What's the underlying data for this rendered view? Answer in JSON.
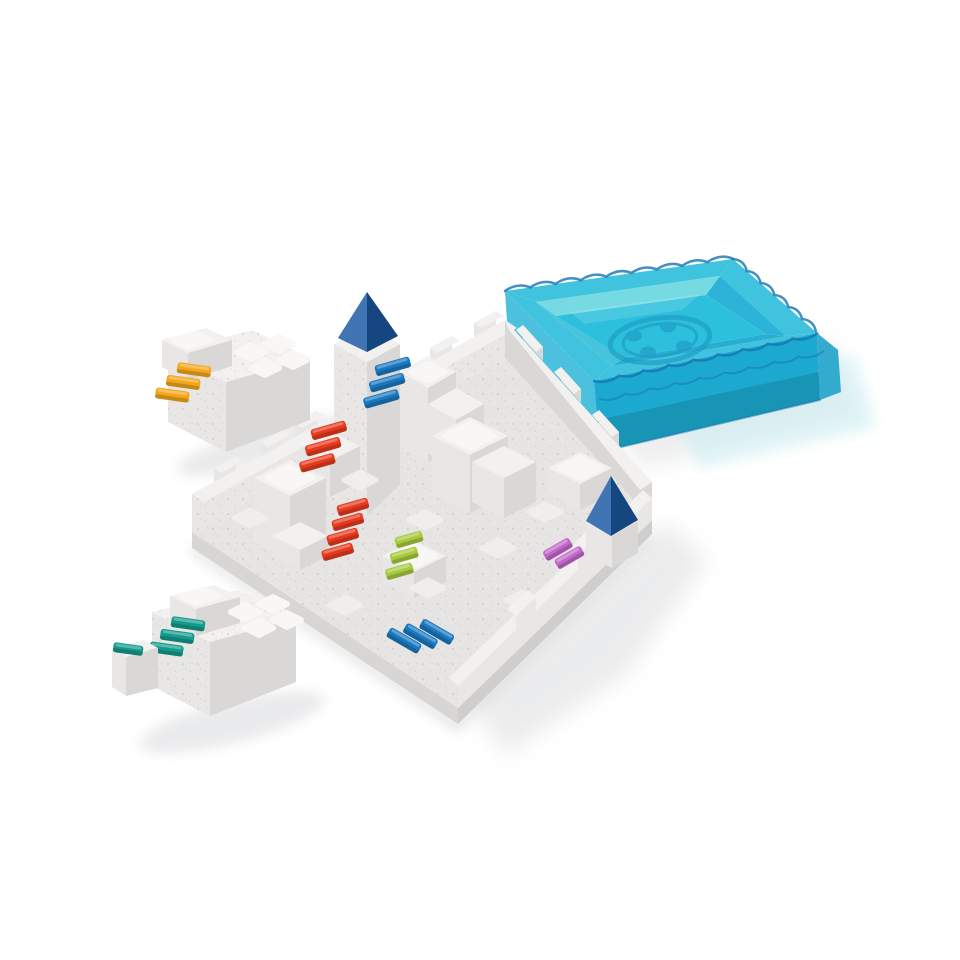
{
  "scene": {
    "description": "Product photo on white background: castle logic-puzzle game. White speckled plastic board with block towers, colored staircases and blue pyramid roofs; two loose white puzzle pieces (orange and teal staircases); transparent teal storage tray lid with scalloped rim and embossed round logo.",
    "background": "#ffffff"
  },
  "palette": {
    "board_base": "#e6e5e3",
    "base_side_left": "#d7d6d4",
    "base_side_right": "#cfcecc",
    "plastic_top": "#f2f1ef",
    "plastic_light": "#e8e7e5",
    "plastic_side": "#d9d8d6",
    "speckle": "#b9b7b5",
    "shadow": "#dcdddf"
  },
  "tray": {
    "name": "transparent teal storage tray lid",
    "rim": "#3fc3de",
    "floor": "#2cc0dc",
    "far_wall": "#76dae3",
    "inner_left": "#45c4dc",
    "inner_right": "#2bb4d8",
    "inner_front": "#27aed2",
    "front_wall": "#1ca9cf",
    "side_wall": "#2db6d8",
    "right_wall": "#1fa3ca",
    "edge": "#1673b0",
    "reflection": "#c8eef2",
    "logo": "#1d9cc4"
  },
  "board": {
    "name": "castle puzzle game board",
    "pyramid_blue": "#1c5aa5",
    "stairs": {
      "blue_upper": "#1a78c0",
      "red_upper": "#e63a1f",
      "red_lower": "#e63a1f",
      "lime": "#a8ca3d",
      "magenta": "#c368cb",
      "blue_front": "#1a78c0"
    }
  },
  "pieces": {
    "top_left": {
      "name": "loose castle piece with orange staircase",
      "stairs": "#f4a61c"
    },
    "bottom_left": {
      "name": "loose castle piece with teal staircase",
      "stairs": "#149a8c"
    }
  }
}
